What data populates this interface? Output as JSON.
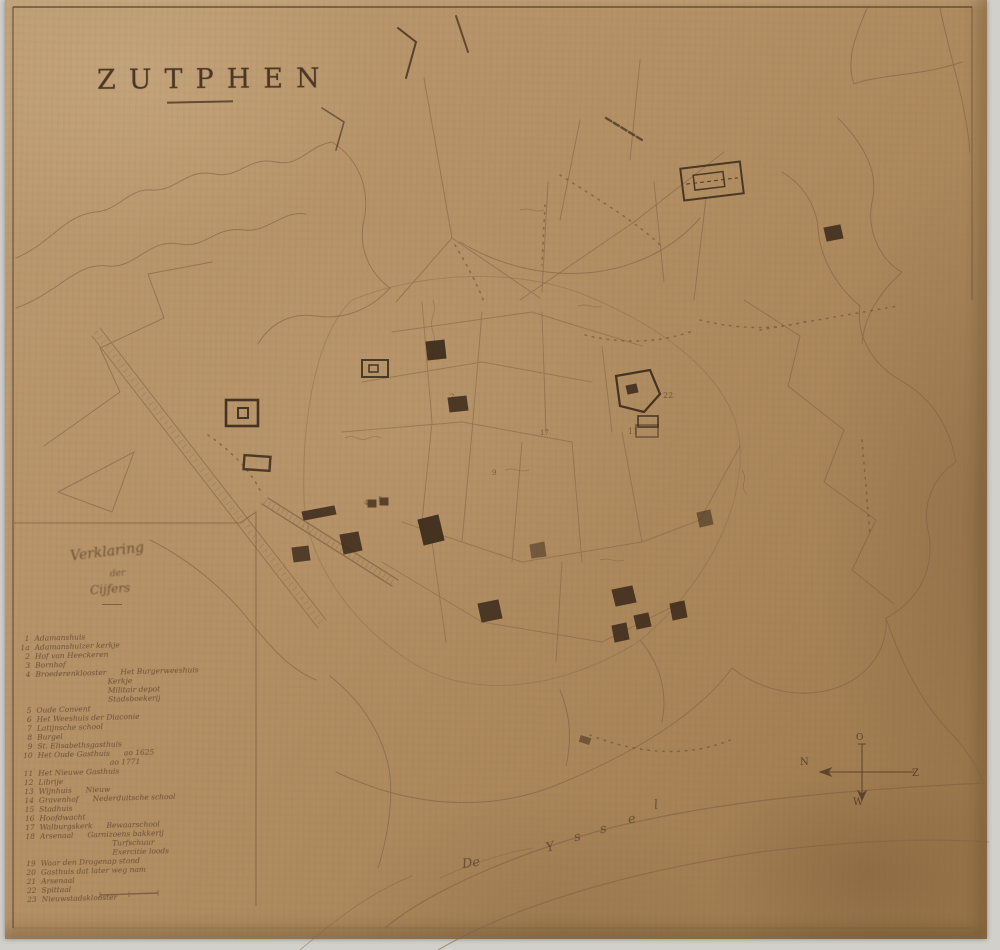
{
  "map": {
    "title": "ZUTPHEN",
    "compass": {
      "north": "N",
      "east": "O",
      "south": "Z",
      "west": "W"
    }
  },
  "river": {
    "article": "De",
    "name": "Yssel"
  },
  "legend": {
    "title1": "Verklaring",
    "title2": "der",
    "title3": "Cijfers",
    "entries": [
      {
        "num": "1",
        "text": "Adamanshuis",
        "note": "",
        "indent": 0
      },
      {
        "num": "1a",
        "text": "Adamanshuizer kerkje",
        "note": "",
        "indent": 0
      },
      {
        "num": "2",
        "text": "Hof van Heeckeren",
        "note": "",
        "indent": 0
      },
      {
        "num": "3",
        "text": "Bornhof",
        "note": "",
        "indent": 0
      },
      {
        "num": "4",
        "text": "Broederenklooster",
        "note": "Het Burgerweeshuis",
        "indent": 0
      },
      {
        "num": "",
        "text": "",
        "note": "Kerkje",
        "indent": 1
      },
      {
        "num": "",
        "text": "",
        "note": "Militair depot",
        "indent": 1
      },
      {
        "num": "",
        "text": "",
        "note": "Stadsboekerij",
        "indent": 1
      },
      {
        "num": "5",
        "text": "Oude Convent",
        "note": "",
        "indent": 0
      },
      {
        "num": "6",
        "text": "Het Weeshuis der Diaconie",
        "note": "",
        "indent": 0
      },
      {
        "num": "7",
        "text": "Latijnsche school",
        "note": "",
        "indent": 0
      },
      {
        "num": "8",
        "text": "Burgel",
        "note": "",
        "indent": 0
      },
      {
        "num": "9",
        "text": "St. Elisabethsgasthuis",
        "note": "",
        "indent": 0
      },
      {
        "num": "10",
        "text": "Het Oude Gasthuis",
        "note": "ao 1625",
        "indent": 0
      },
      {
        "num": "",
        "text": "",
        "note": "ao 1771",
        "indent": 1
      },
      {
        "num": "11",
        "text": "Het Nieuwe Gasthuis",
        "note": "",
        "indent": 0
      },
      {
        "num": "12",
        "text": "Librije",
        "note": "",
        "indent": 0
      },
      {
        "num": "13",
        "text": "Wijnhuis",
        "note": "Nieuw",
        "indent": 0
      },
      {
        "num": "14",
        "text": "Gravenhof",
        "note": "Nederduitsche school",
        "indent": 0
      },
      {
        "num": "15",
        "text": "Stadhuis",
        "note": "",
        "indent": 0
      },
      {
        "num": "16",
        "text": "Hoofdwacht",
        "note": "",
        "indent": 0
      },
      {
        "num": "17",
        "text": "Walburgskerk",
        "note": "Bewaarschool",
        "indent": 0
      },
      {
        "num": "18",
        "text": "Arsenaal",
        "note": "Garnizoens bakkerij",
        "indent": 0
      },
      {
        "num": "",
        "text": "",
        "note": "Turfschuur",
        "indent": 1
      },
      {
        "num": "",
        "text": "",
        "note": "Exercitie loods",
        "indent": 1
      },
      {
        "num": "19",
        "text": "Waar den Drogenap stond",
        "note": "",
        "indent": 0
      },
      {
        "num": "20",
        "text": "Gasthuis dat later weg nam",
        "note": "",
        "indent": 0
      },
      {
        "num": "21",
        "text": "Arsenaal",
        "note": "",
        "indent": 0
      },
      {
        "num": "22",
        "text": "Spittaal",
        "note": "",
        "indent": 0
      },
      {
        "num": "23",
        "text": "Nieuwstadsklooster",
        "note": "",
        "indent": 0
      }
    ]
  },
  "map_labels": [
    {
      "text": "N",
      "x": 800,
      "y": 757,
      "size": 10,
      "kind": "compass"
    },
    {
      "text": "O",
      "x": 856,
      "y": 733,
      "size": 9,
      "kind": "compass"
    },
    {
      "text": "Z",
      "x": 912,
      "y": 768,
      "size": 10,
      "kind": "compass"
    },
    {
      "text": "W",
      "x": 853,
      "y": 797,
      "size": 10,
      "kind": "compass"
    },
    {
      "text": "22",
      "x": 663,
      "y": 391,
      "size": 8,
      "kind": "number"
    },
    {
      "text": "11",
      "x": 628,
      "y": 427,
      "size": 8,
      "kind": "number"
    },
    {
      "text": "1",
      "x": 434,
      "y": 345,
      "size": 7,
      "kind": "number"
    },
    {
      "text": "2",
      "x": 450,
      "y": 393,
      "size": 7,
      "kind": "number"
    },
    {
      "text": "4",
      "x": 364,
      "y": 499,
      "size": 7,
      "kind": "number"
    },
    {
      "text": "5",
      "x": 378,
      "y": 496,
      "size": 7,
      "kind": "number"
    },
    {
      "text": "9",
      "x": 492,
      "y": 469,
      "size": 7,
      "kind": "number"
    },
    {
      "text": "17",
      "x": 540,
      "y": 429,
      "size": 7,
      "kind": "number"
    }
  ],
  "colors": {
    "paper": "#b38f64",
    "ink_dark": "#3e2c1b",
    "ink_faint": "#7d6143",
    "photo_background": "#d2d0ca"
  }
}
